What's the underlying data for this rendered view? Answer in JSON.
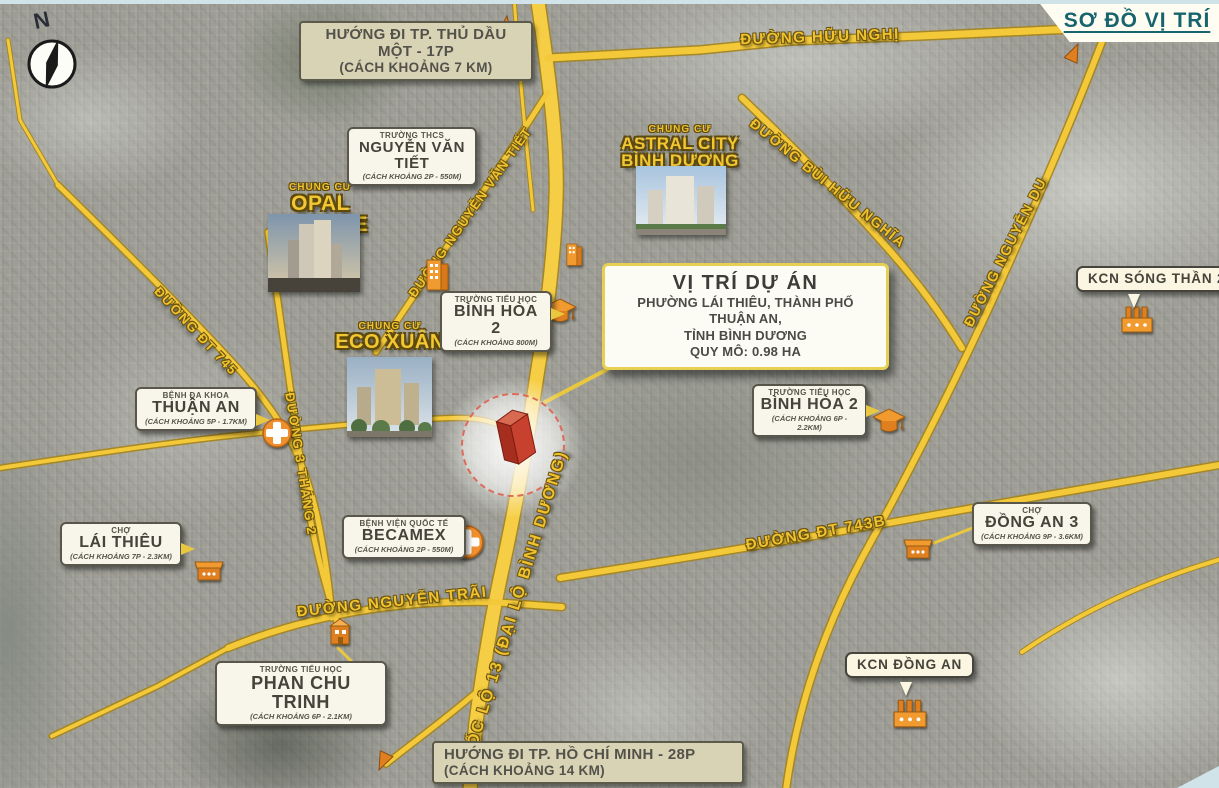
{
  "header": {
    "title": "SƠ ĐỒ VỊ TRÍ"
  },
  "compass": {
    "north_label": "N"
  },
  "directions": {
    "thu_dau_mot": {
      "line1": "HƯỚNG ĐI TP. THỦ DẦU MỘT - 17P",
      "line2": "(CÁCH KHOẢNG 7 KM)"
    },
    "ho_chi_minh": {
      "line1": "HƯỚNG ĐI TP. HỒ CHÍ MINH - 28P",
      "line2": "(CÁCH KHOẢNG 14 KM)"
    }
  },
  "project": {
    "title": "VỊ TRÍ DỰ ÁN",
    "line1": "PHƯỜNG LÁI THIÊU, THÀNH PHỐ THUẬN AN,",
    "line2": "TỈNH BÌNH DƯƠNG",
    "line3": "QUY MÔ: 0.98 HA"
  },
  "apartments": {
    "opal": {
      "type": "CHUNG CƯ",
      "name": "OPAL SKYLINE"
    },
    "astral": {
      "type": "CHUNG CƯ",
      "name": "ASTRAL CITY",
      "name2": "BÌNH DƯƠNG"
    },
    "eco": {
      "type": "CHUNG CƯ",
      "name": "ECO XUÂN"
    }
  },
  "pois": {
    "nguyen_van_tiet": {
      "type": "TRƯỜNG THCS",
      "name": "NGUYỄN VĂN TIẾT",
      "distance": "(CÁCH KHOẢNG 2P - 550M)"
    },
    "binh_hoa_2_tay": {
      "type": "TRƯỜNG TIỂU HỌC",
      "name": "BÌNH HÒA 2",
      "distance": "(CÁCH KHOẢNG 800M)"
    },
    "thuan_an": {
      "type": "BỆNH ĐA KHOA",
      "name": "THUẬN AN",
      "distance": "(CÁCH KHOẢNG 5P - 1.7KM)"
    },
    "binh_hoa_2_dong": {
      "type": "TRƯỜNG TIỂU HỌC",
      "name": "BÌNH HÒA 2",
      "distance": "(CÁCH KHOẢNG 6P - 2.2KM)"
    },
    "lai_thieu": {
      "type": "CHỢ",
      "name": "LÁI THIÊU",
      "distance": "(CÁCH KHOẢNG 7P - 2.3KM)"
    },
    "becamex": {
      "type": "BỆNH VIỆN QUỐC TẾ",
      "name": "BECAMEX",
      "distance": "(CÁCH KHOẢNG 2P - 550M)"
    },
    "dong_an_3": {
      "type": "CHỢ",
      "name": "ĐỒNG AN 3",
      "distance": "(CÁCH KHOẢNG 9P - 3.6KM)"
    },
    "phan_chu_trinh": {
      "type": "TRƯỜNG TIỂU HỌC",
      "name": "PHAN CHU TRINH",
      "distance": "(CÁCH KHOẢNG 6P - 2.1KM)"
    }
  },
  "industrial_zones": {
    "song_than_2": {
      "name": "KCN SÓNG THẦN 2"
    },
    "dong_an": {
      "name": "KCN ĐỒNG AN"
    }
  },
  "roads": {
    "huu_nghi": {
      "label": "ĐƯỜNG HỮU NGHỊ"
    },
    "bui_huu_nghia": {
      "label": "ĐƯỜNG BÙI HỮU NGHĨA"
    },
    "nguyen_du": {
      "label": "ĐƯỜNG NGUYỄN DU"
    },
    "nguyen_van_tiet": {
      "label": "ĐƯỜNG NGUYỄN VĂN TIẾT"
    },
    "dt_745": {
      "label": "ĐƯỜNG ĐT 745"
    },
    "ba_thang_hai": {
      "label": "ĐƯỜNG 3 THÁNG 2"
    },
    "nguyen_trai": {
      "label": "ĐƯỜNG NGUYỄN TRÃI"
    },
    "dt_743b": {
      "label": "ĐƯỜNG ĐT 743B"
    },
    "quoc_lo_13": {
      "label": "QUỐC LỘ 13 (ĐẠI LỘ BÌNH DƯƠNG)"
    }
  },
  "colors": {
    "road_yellow": "#f3c93a",
    "label_yellow": "#f0c32e",
    "icon_orange": "#ef8f2e",
    "title_teal": "#17646f",
    "marker_red": "#c23b2e"
  }
}
